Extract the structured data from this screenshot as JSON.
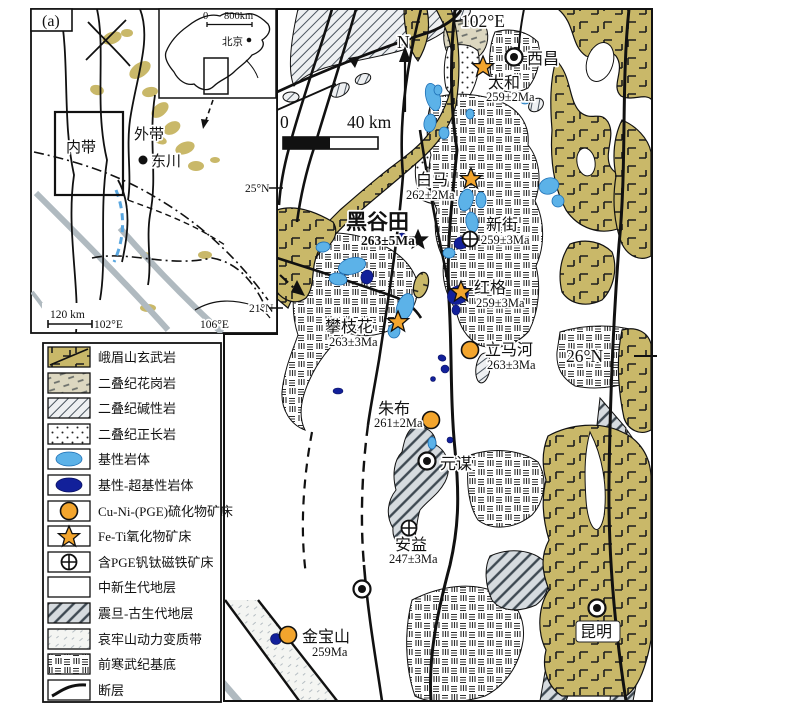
{
  "panel": {
    "label": "(a)"
  },
  "inset": {
    "china": {
      "scale_zero": "0",
      "scale": "800km",
      "capital": "北京"
    },
    "belt_inner": "内带",
    "belt_outer": "外带",
    "city": "东川",
    "scale": "120 km",
    "lon_w": "102°E",
    "lon_e": "106°E",
    "lat_n": "25°N",
    "lat_s": "21°N"
  },
  "map": {
    "lon": "102°E",
    "lat": "26°N",
    "north": "N",
    "scale_zero": "0",
    "scale": "40 km",
    "cities": {
      "xichang": "西昌",
      "yuanmou": "元谋",
      "kunming": "昆明"
    },
    "sites": {
      "taihe": {
        "name": "太和",
        "age": "259±2Ma"
      },
      "baima": {
        "name": "白马",
        "age": "262±2Ma"
      },
      "heigutian": {
        "name": "黑谷田",
        "age": "263±5Ma"
      },
      "xinjie": {
        "name": "新街",
        "age": "259±3Ma"
      },
      "hongge": {
        "name": "红格",
        "age": "259±3Ma"
      },
      "panzhihua": {
        "name": "攀枝花",
        "age": "263±3Ma"
      },
      "limahe": {
        "name": "立马河",
        "age": "263±3Ma"
      },
      "zhubu": {
        "name": "朱布",
        "age": "261±2Ma"
      },
      "anyi": {
        "name": "安益",
        "age": "247±3Ma"
      },
      "jinbaoshan": {
        "name": "金宝山",
        "age": "259Ma"
      }
    }
  },
  "legend": {
    "items": [
      {
        "label": "峨眉山玄武岩"
      },
      {
        "label": "二叠纪花岗岩"
      },
      {
        "label": "二叠纪碱性岩"
      },
      {
        "label": "二叠纪正长岩"
      },
      {
        "label": "基性岩体"
      },
      {
        "label": "基性-超基性岩体"
      },
      {
        "label": "Cu-Ni-(PGE)硫化物矿床"
      },
      {
        "label": "Fe-Ti氧化物矿床"
      },
      {
        "label": "含PGE钒钛磁铁矿床"
      },
      {
        "label": "中新生代地层"
      },
      {
        "label": "震旦-古生代地层"
      },
      {
        "label": "哀牢山动力变质带"
      },
      {
        "label": "前寒武纪基底"
      },
      {
        "label": "断层"
      }
    ]
  },
  "colors": {
    "basalt_khaki": "#c9b869",
    "mafic_blue": "#5cb2e8",
    "ultramafic_navy": "#12209a",
    "deposit_orange": "#f3a52d",
    "strata_gray": "#d6dbdf",
    "river_gray": "#b0bac0"
  }
}
